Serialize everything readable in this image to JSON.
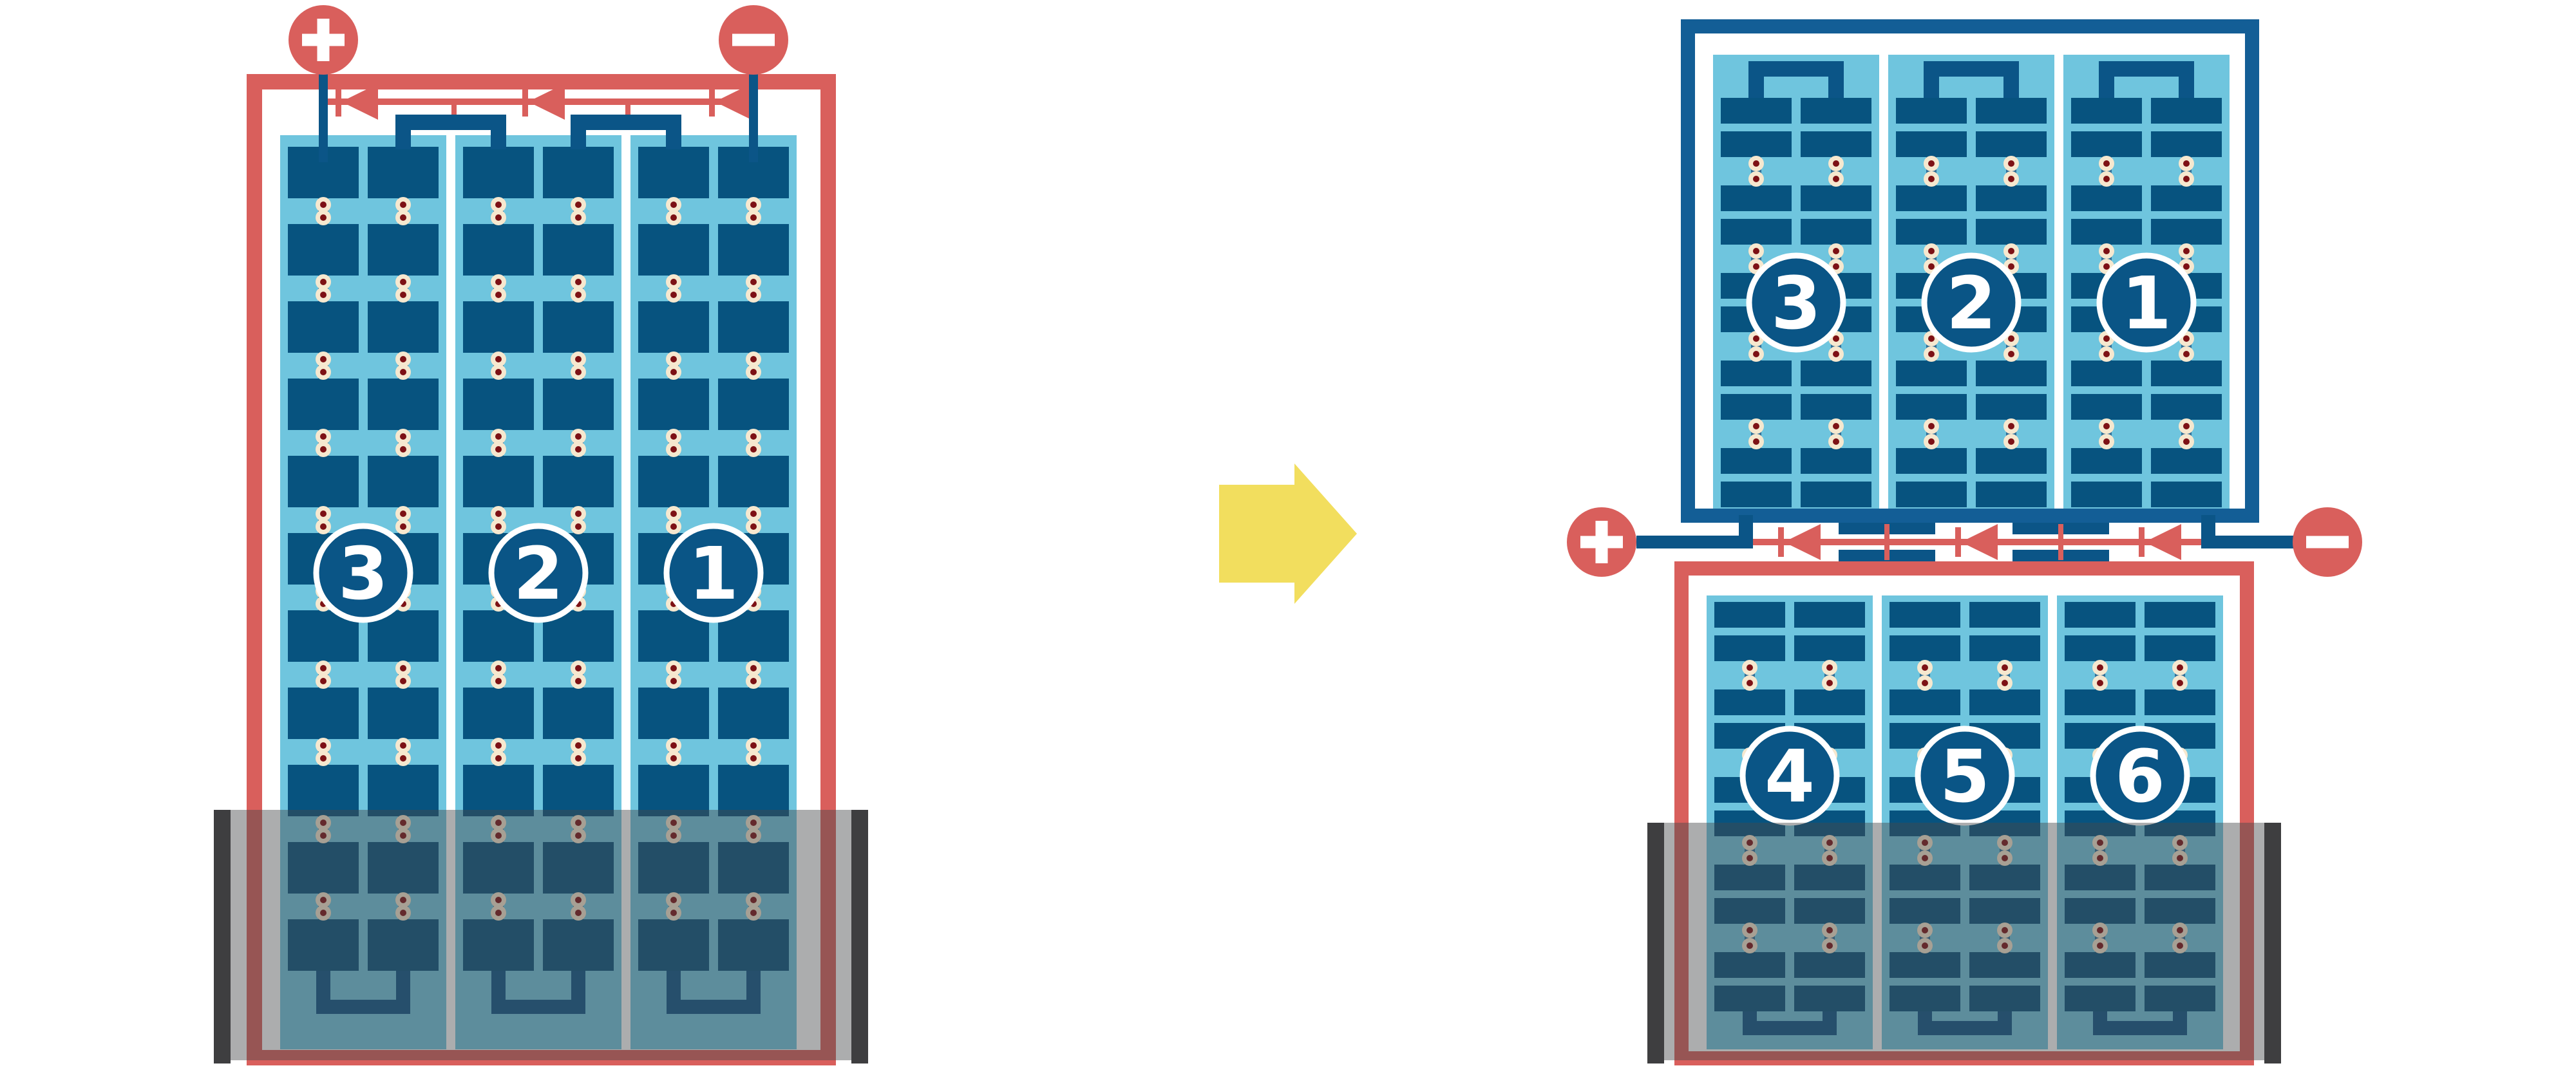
{
  "colors": {
    "red": "#D95F5C",
    "navy_frame": "#135E96",
    "cell": "#07537F",
    "connector": "#0B5587",
    "tab": "#2E6E98",
    "panel_bg": "#6FC5DE",
    "dot_ring": "#F6E8CF",
    "dot_core": "#7D1115",
    "badge_fill": "#0A5586",
    "badge_stroke": "#FFFFFF",
    "badge_text": "#FFFFFF",
    "shade_overlay": "rgba(72,73,75,0.45)",
    "shade_bar": "#3E3E40",
    "arrow": "#F2DE5E",
    "white": "#FFFFFF"
  },
  "left_panel": {
    "terminals": {
      "positive": "+",
      "negative": "−"
    },
    "strings": [
      {
        "label": "3"
      },
      {
        "label": "2"
      },
      {
        "label": "1"
      }
    ],
    "diode_count": 3
  },
  "right_panel": {
    "terminals": {
      "positive": "+",
      "negative": "−"
    },
    "top_strings": [
      {
        "label": "3"
      },
      {
        "label": "2"
      },
      {
        "label": "1"
      }
    ],
    "bottom_strings": [
      {
        "label": "4"
      },
      {
        "label": "5"
      },
      {
        "label": "6"
      }
    ],
    "diode_count": 3
  },
  "arrow": {
    "direction": "right"
  }
}
